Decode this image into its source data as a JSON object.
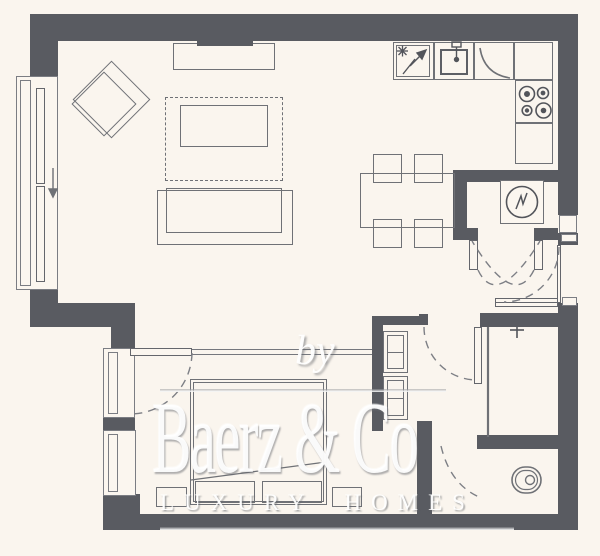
{
  "watermark": {
    "prefix": "by",
    "brand": "Baerz & Co",
    "tagline": "LUXURY HOMES"
  },
  "palette": {
    "background": "#faf5ee",
    "wall": "#595b61",
    "furniture_line": "#6f7176",
    "watermark_text": "#ffffff"
  },
  "icons": [
    "snowflake-icon",
    "fridge-arrow-icon",
    "sink-faucet-icon",
    "hob-burners-icon",
    "boiler-dial-icon",
    "shower-head-icon",
    "toilet-icon",
    "window-slide-arrow-icon",
    "door-swing-arc"
  ]
}
